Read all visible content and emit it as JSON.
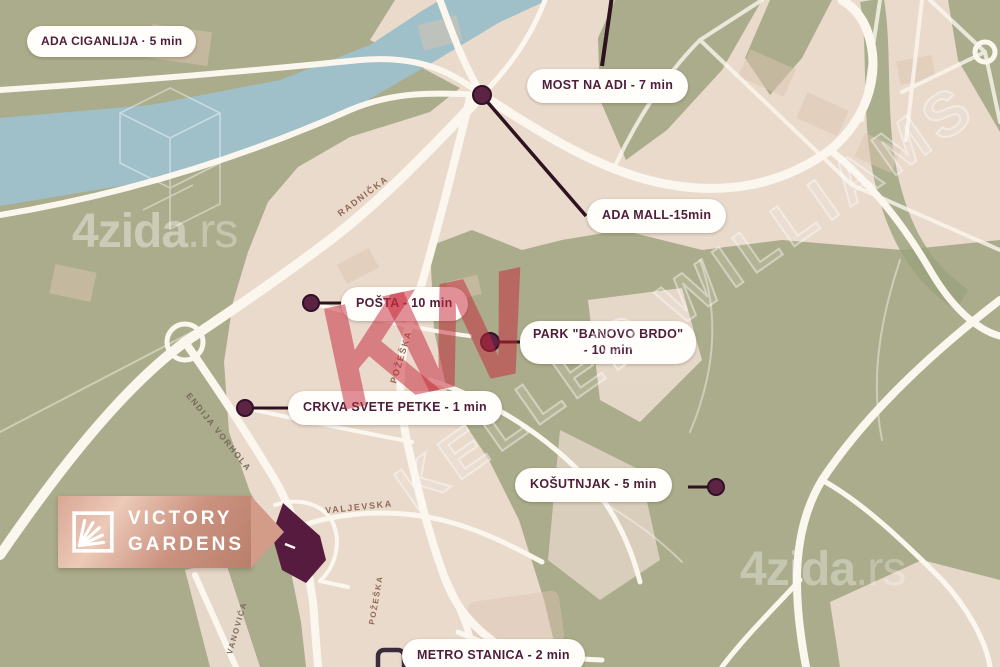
{
  "map_type": "neighborhood-poi-map",
  "development": {
    "line1": "VICTORY",
    "line2": "GARDENS"
  },
  "pois": [
    {
      "id": "ada-ciganlija",
      "label": "ADA CIGANLIJA · 5 min"
    },
    {
      "id": "most-na-adi",
      "label": "MOST NA ADI - 7 min"
    },
    {
      "id": "ada-mall",
      "label": "ADA MALL-15min"
    },
    {
      "id": "posta",
      "label": "POŠTA - 10 min"
    },
    {
      "id": "park-banovo-brdo",
      "label": "PARK \"BANOVO BRDO\"",
      "label2": "- 10 min"
    },
    {
      "id": "crkva-svete-petke",
      "label": "CRKVA SVETE PETKE - 1 min"
    },
    {
      "id": "kosutnjak",
      "label": "KOŠUTNJAK - 5 min"
    },
    {
      "id": "metro-stanica",
      "label": "METRO STANICA - 2 min"
    }
  ],
  "streets": [
    {
      "name": "RADNIČKA"
    },
    {
      "name": "POŽEŠKA"
    },
    {
      "name": "ENDIJA VORHOLA"
    },
    {
      "name": "VALJEVSKA"
    },
    {
      "name": "POŽEŠKA"
    },
    {
      "name": "VANOVIĆA"
    }
  ],
  "watermarks": {
    "brand": "4zida",
    "brand_tld": ".rs",
    "agency_initials": "KW",
    "agency_name": "KELLER WILLIAMS"
  },
  "colors": {
    "land": "#e9dacc",
    "park": "#abac8b",
    "water": "#9fc0c8",
    "road": "#fbf7ef",
    "marker": "#5d2342",
    "marker_line": "#2e1220",
    "label_text": "#4f1d3a",
    "kw_red": "#c62a3c",
    "property": "#571b40",
    "logo_gold": "#c98d78"
  }
}
